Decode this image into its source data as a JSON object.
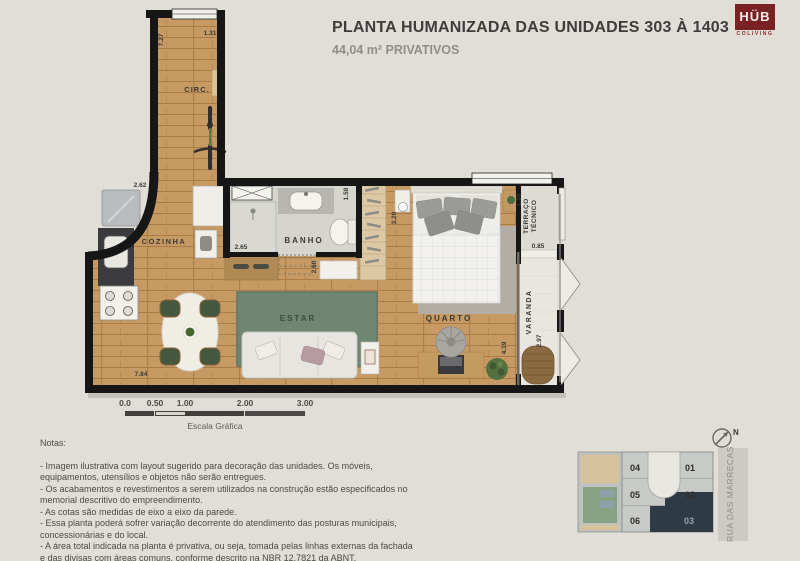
{
  "header": {
    "title": "PLANTA HUMANIZADA DAS UNIDADES 303 À 1403",
    "subtitle": "44,04 m² PRIVATIVOS"
  },
  "logo": {
    "name": "HÜB",
    "tagline": "COLIVING",
    "bg_color": "#7a2124"
  },
  "plan": {
    "rooms": {
      "circ": "CIRC.",
      "cozinha": "COZINHA",
      "banho": "BANHO",
      "estar": "ESTAR",
      "quarto": "QUARTO",
      "varanda": "VARANDA",
      "terraco_line1": "TERRAÇO",
      "terraco_line2": "TÉCNICO"
    },
    "dims": {
      "circ_height": "7.27",
      "circ_width": "1.31",
      "cozinha_width": "2.62",
      "banho_width": "2.65",
      "banho_height": "1.58",
      "quarto_width": "3.20",
      "terraco_height": "1.20",
      "varanda_width": "0.85",
      "varanda_height": "2.97",
      "quarto_height": "4.19",
      "estar_depth": "2.60",
      "total_width": "7.84"
    }
  },
  "scalebar": {
    "ticks": [
      "0.0",
      "0.50",
      "1.00",
      "2.00",
      "3.00"
    ],
    "label": "Escala Gráfica"
  },
  "notes": {
    "heading": "Notas:",
    "items": [
      "- Imagem ilustrativa com layout sugerido para decoração das unidades. Os móveis, equipamentos, utensílios e objetos não serão entregues.",
      "- Os acabamentos e revestimentos a serem utilizados na construção estão especificados no memorial descritivo do empreendimento.",
      "- As cotas são medidas de eixo a eixo da parede.",
      "- Essa planta poderá sofrer variação decorrente do atendimento das posturas municipais, concessionárias e do local.",
      "- A área total indicada na planta é privativa, ou seja, tomada pelas linhas externas da fachada e das divisas com áreas comuns, conforme descrito na NBR 12.7821 da ABNT."
    ]
  },
  "keyplan": {
    "units": [
      "04",
      "01",
      "05",
      "02",
      "06",
      "03"
    ],
    "highlighted_unit": "03",
    "street": "RUA DAS MARRECAS",
    "north_label": "N"
  },
  "colors": {
    "background": "#e1ded7",
    "wall": "#161616",
    "wood_floor": "#c79a63",
    "rug_green": "#6e8672",
    "keyplan_highlight": "#2e3a44",
    "logo_red": "#7a2124"
  }
}
